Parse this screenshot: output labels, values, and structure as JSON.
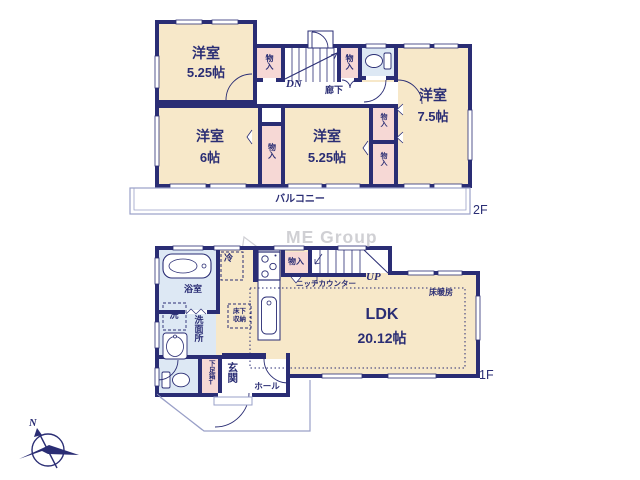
{
  "palette": {
    "wall": "#2a2d74",
    "room_cream": "#f7e8c9",
    "closet_pink": "#f6d8d5",
    "wet_blue": "#dde8f4",
    "thin_line": "#9aa0c8",
    "text": "#2a2d74",
    "watermark": "#d0d0d4"
  },
  "watermark": "ME Group",
  "compass": {
    "north": "N"
  },
  "floor2": {
    "label": "2F",
    "balcony": "バルコニー",
    "hallway": "廊下",
    "stairs_down": "DN",
    "room_nw": {
      "name": "洋室",
      "size": "5.25帖"
    },
    "room_w": {
      "name": "洋室",
      "size": "6帖"
    },
    "room_center": {
      "name": "洋室",
      "size": "5.25帖"
    },
    "room_e": {
      "name": "洋室",
      "size": "7.5帖"
    },
    "closet_nw": "物入",
    "closet_n": "物入",
    "closet_mid": "物入",
    "closet_e_upper": "物入",
    "closet_e_lower": "物入"
  },
  "floor1": {
    "label": "1F",
    "ldk": {
      "name": "LDK",
      "size": "20.12帖"
    },
    "floor_heating": "床暖房",
    "niche_counter": "ニッチカウンター",
    "closet": "物入",
    "stairs_up": "UP",
    "refrigerator": "冷",
    "underfloor_storage": "床下収納",
    "bathroom": "浴室",
    "washer": "洗",
    "washroom": "洗面所",
    "entrance": "玄関",
    "hall": "ホール",
    "shoe_cabinet": "下足箱T"
  }
}
